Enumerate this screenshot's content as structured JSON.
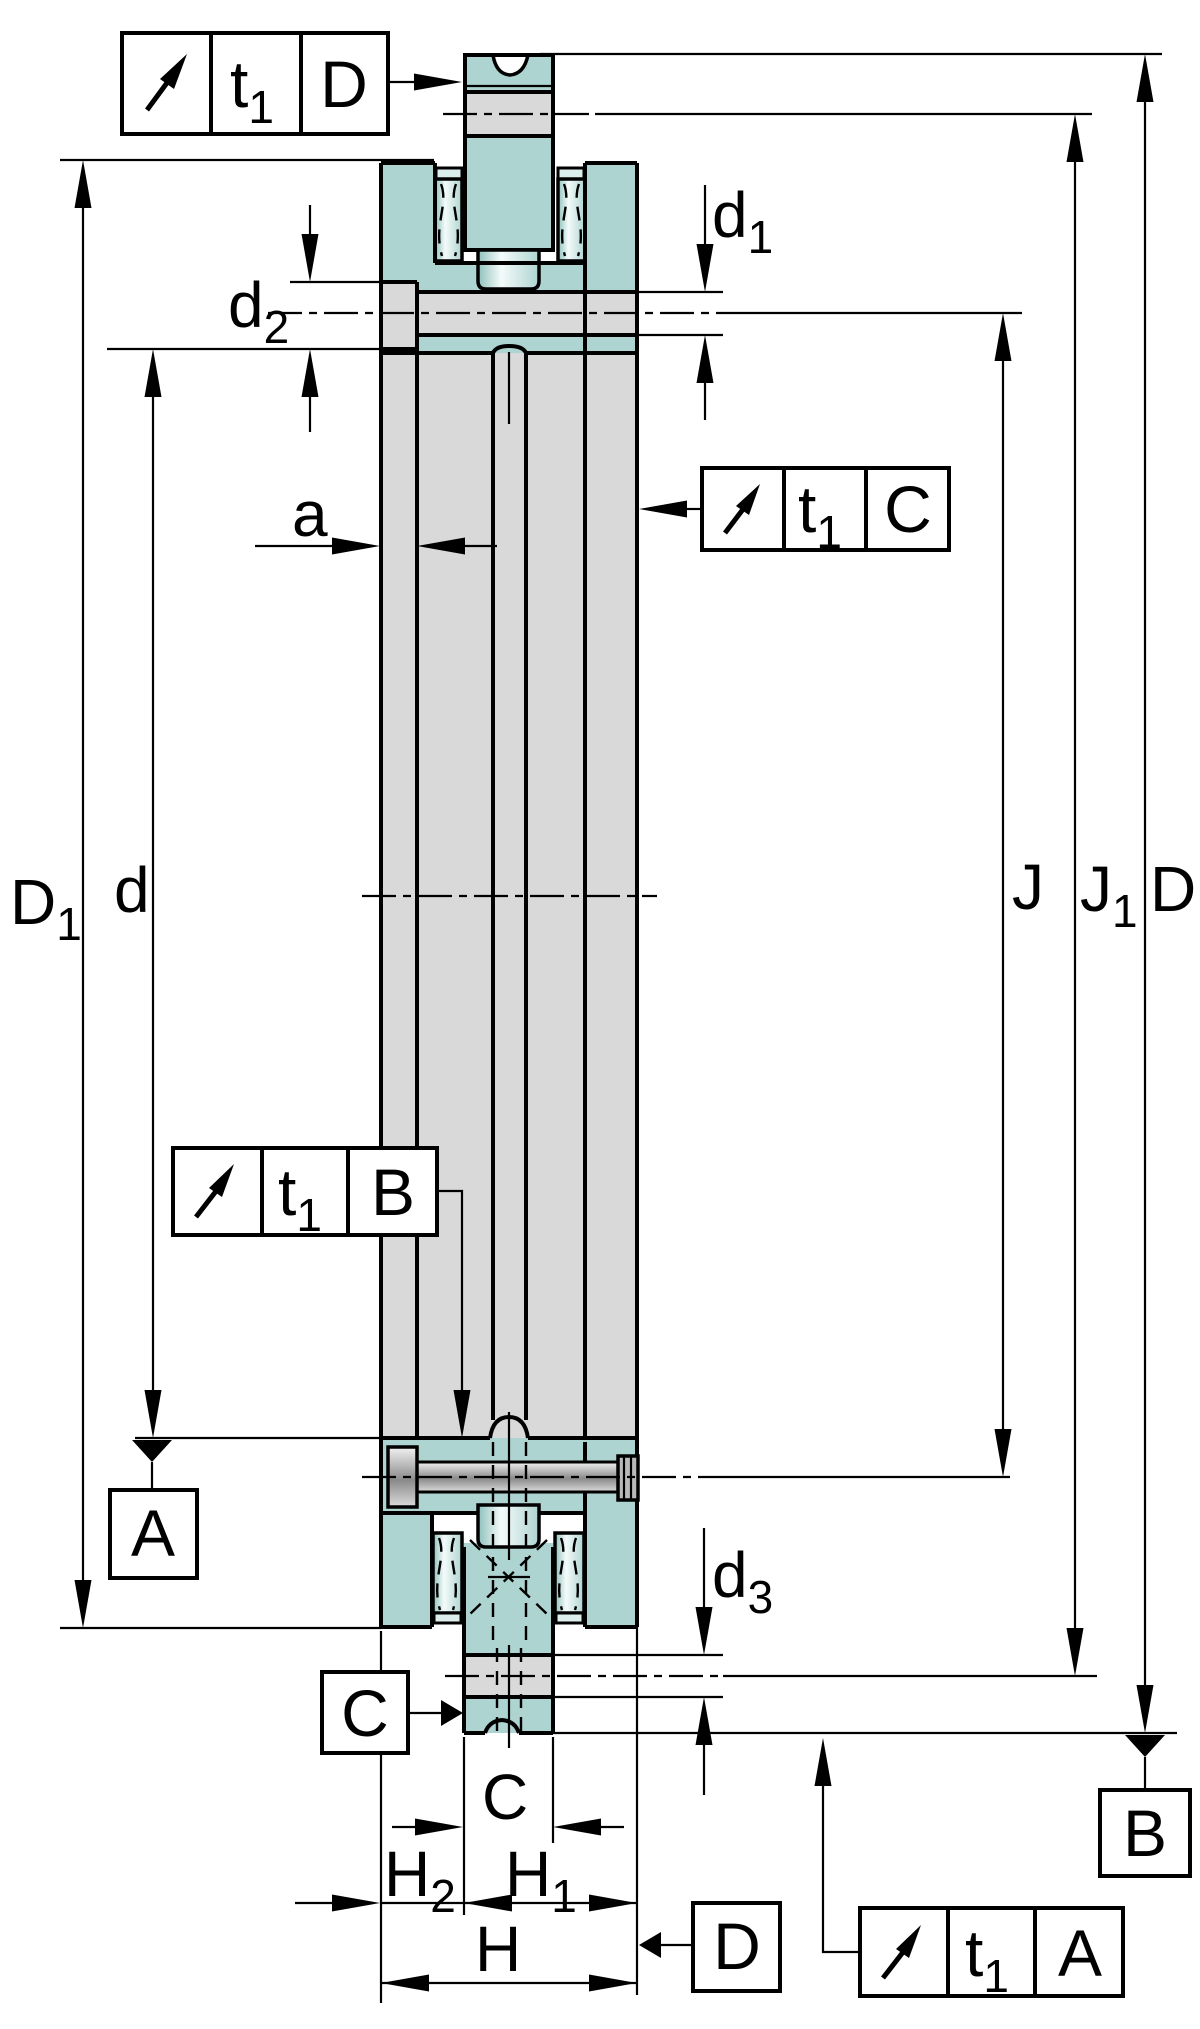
{
  "drawing": {
    "type": "bearing cross-section dimensional drawing",
    "colors": {
      "teal": "#aed4d1",
      "teal_light": "#dceeec",
      "gray": "#d9d9d9",
      "line": "#000000",
      "metal_dark": "#8a8a8a"
    },
    "frames": {
      "top": {
        "symbol": "circular-runout-arrow",
        "tol": "t",
        "tol_sub": "1",
        "datum": "D"
      },
      "right": {
        "symbol": "circular-runout-arrow",
        "tol": "t",
        "tol_sub": "1",
        "datum": "C"
      },
      "left": {
        "symbol": "circular-runout-arrow",
        "tol": "t",
        "tol_sub": "1",
        "datum": "B"
      },
      "bottom": {
        "symbol": "circular-runout-arrow",
        "tol": "t",
        "tol_sub": "1",
        "datum": "A"
      }
    },
    "datums": {
      "A": "A",
      "B": "B",
      "C": "C",
      "D": "D"
    },
    "dims": {
      "d1": {
        "base": "d",
        "sub": "1"
      },
      "d2": {
        "base": "d",
        "sub": "2"
      },
      "d3": {
        "base": "d",
        "sub": "3"
      },
      "a": {
        "base": "a"
      },
      "D1": {
        "base": "D",
        "sub": "1"
      },
      "d": {
        "base": "d"
      },
      "J": {
        "base": "J"
      },
      "J1": {
        "base": "J",
        "sub": "1"
      },
      "Dd": {
        "base": "D"
      },
      "C": {
        "base": "C"
      },
      "H": {
        "base": "H"
      },
      "H1": {
        "base": "H",
        "sub": "1"
      },
      "H2": {
        "base": "H",
        "sub": "2"
      }
    }
  }
}
